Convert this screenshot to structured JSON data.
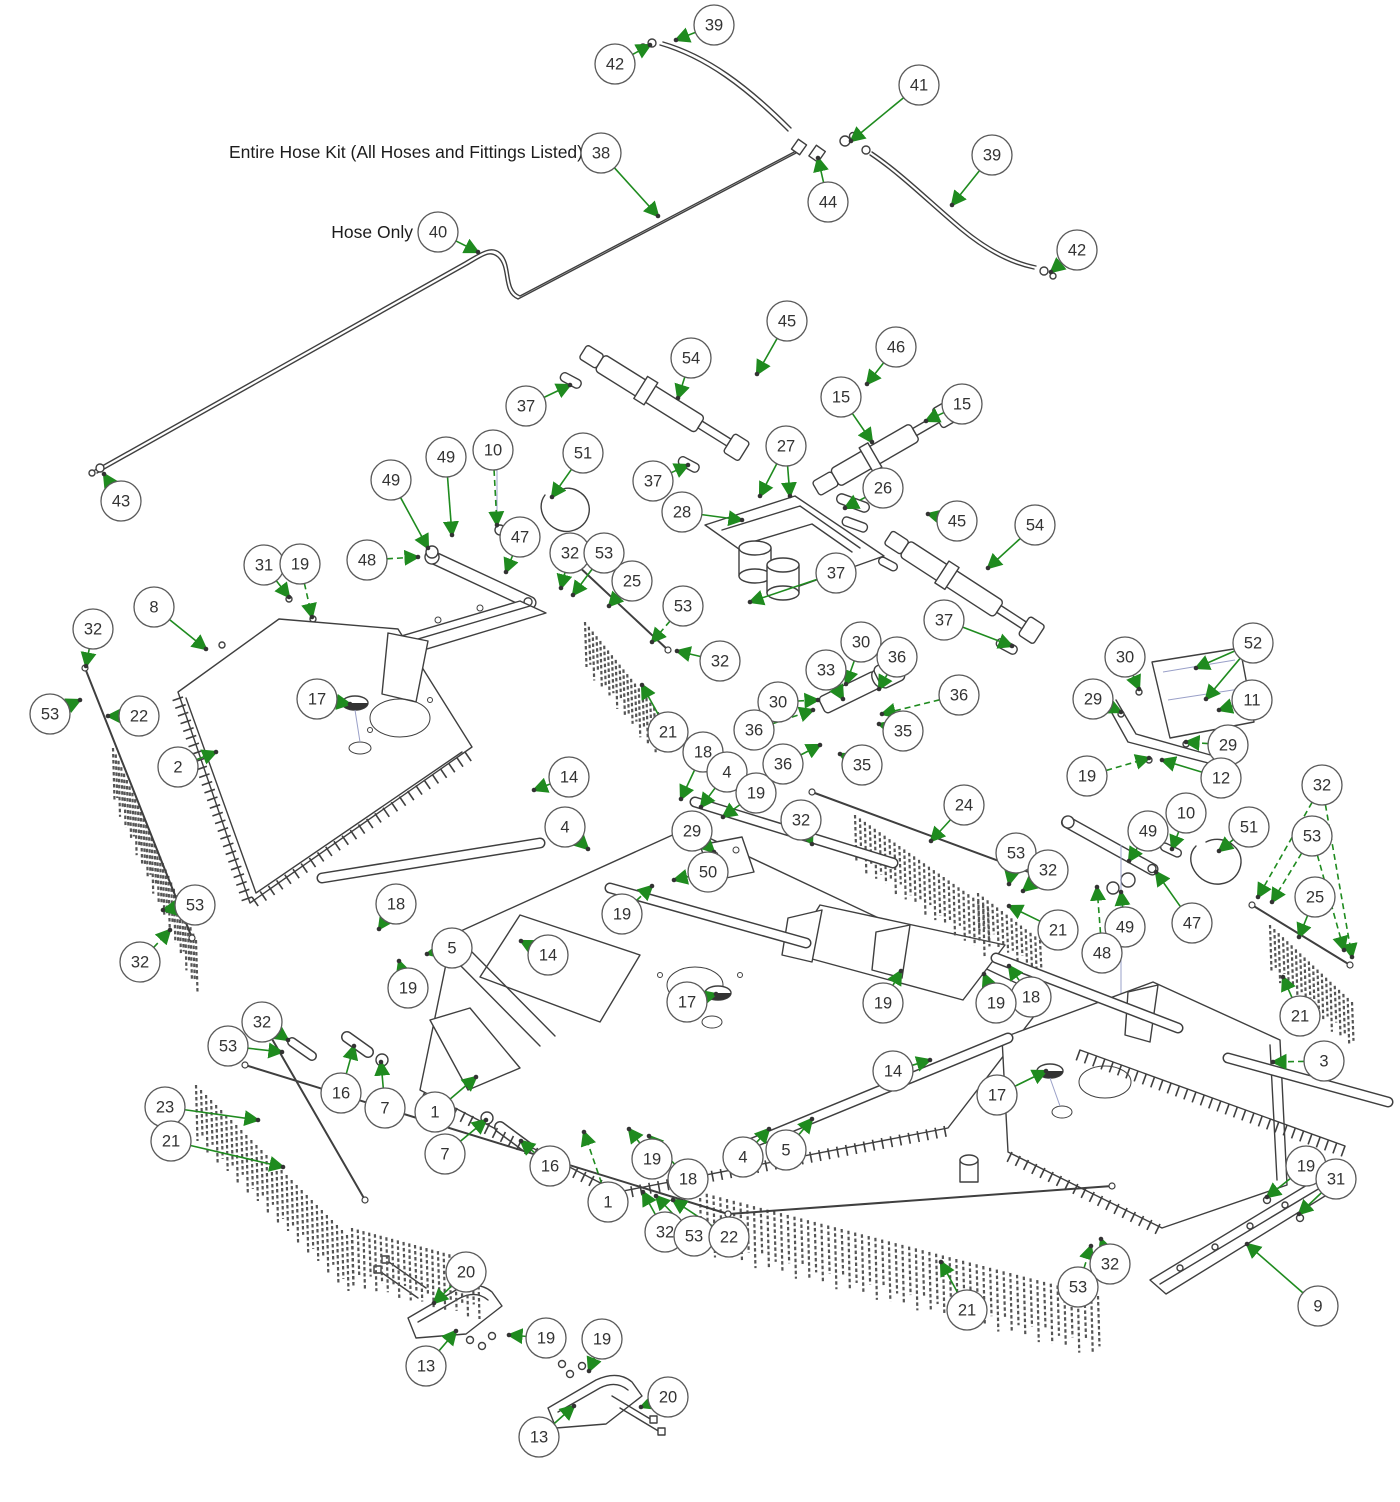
{
  "diagram": {
    "labels": {
      "hose_kit": "Entire Hose Kit (All Hoses and Fittings Listed)",
      "hose_only": "Hose Only"
    },
    "colors": {
      "arrow": "#1f8b1f",
      "line": "#3f3f3f",
      "balloon_stroke": "#5a5a5a",
      "chain": "#555555"
    },
    "balloon_radius": 20,
    "callouts": [
      {
        "n": "39",
        "x": 714,
        "y": 25,
        "tx": 676,
        "ty": 40
      },
      {
        "n": "42",
        "x": 615,
        "y": 64,
        "tx": 650,
        "ty": 45
      },
      {
        "n": "41",
        "x": 919,
        "y": 85,
        "tx": 851,
        "ty": 141
      },
      {
        "n": "38",
        "x": 601,
        "y": 153,
        "tx": 658,
        "ty": 216
      },
      {
        "n": "44",
        "x": 828,
        "y": 202,
        "tx": 818,
        "ty": 158
      },
      {
        "n": "39",
        "x": 992,
        "y": 155,
        "tx": 952,
        "ty": 205
      },
      {
        "n": "42",
        "x": 1077,
        "y": 250,
        "tx": 1051,
        "ty": 272
      },
      {
        "n": "40",
        "x": 438,
        "y": 232,
        "tx": 478,
        "ty": 252
      },
      {
        "n": "43",
        "x": 121,
        "y": 501,
        "tx": 104,
        "ty": 474
      },
      {
        "n": "37",
        "x": 526,
        "y": 406,
        "tx": 570,
        "ty": 385
      },
      {
        "n": "54",
        "x": 691,
        "y": 358,
        "tx": 678,
        "ty": 398
      },
      {
        "n": "45",
        "x": 787,
        "y": 321,
        "tx": 757,
        "ty": 374
      },
      {
        "n": "46",
        "x": 896,
        "y": 347,
        "tx": 867,
        "ty": 384
      },
      {
        "n": "15",
        "x": 841,
        "y": 397,
        "tx": 872,
        "ty": 442
      },
      {
        "n": "15",
        "x": 962,
        "y": 404,
        "tx": 926,
        "ty": 421
      },
      {
        "n": "37",
        "x": 653,
        "y": 481,
        "tx": 688,
        "ty": 465
      },
      {
        "n": "27",
        "x": 786,
        "y": 446,
        "tx": 760,
        "ty": 496,
        "t2x": 790,
        "t2y": 496
      },
      {
        "n": "28",
        "x": 682,
        "y": 512,
        "tx": 742,
        "ty": 520
      },
      {
        "n": "26",
        "x": 883,
        "y": 488,
        "tx": 845,
        "ty": 508,
        "dash": true
      },
      {
        "n": "45",
        "x": 957,
        "y": 521,
        "tx": 928,
        "ty": 514
      },
      {
        "n": "54",
        "x": 1035,
        "y": 525,
        "tx": 988,
        "ty": 568
      },
      {
        "n": "37",
        "x": 836,
        "y": 573,
        "tx": 750,
        "ty": 602
      },
      {
        "n": "37",
        "x": 944,
        "y": 620,
        "tx": 1012,
        "ty": 646
      },
      {
        "n": "10",
        "x": 493,
        "y": 450,
        "tx": 497,
        "ty": 525,
        "dash": true
      },
      {
        "n": "51",
        "x": 583,
        "y": 453,
        "tx": 552,
        "ty": 497
      },
      {
        "n": "49",
        "x": 391,
        "y": 480,
        "tx": 428,
        "ty": 548
      },
      {
        "n": "49",
        "x": 446,
        "y": 457,
        "tx": 452,
        "ty": 535
      },
      {
        "n": "48",
        "x": 367,
        "y": 560,
        "tx": 418,
        "ty": 557,
        "dash": true
      },
      {
        "n": "47",
        "x": 520,
        "y": 537,
        "tx": 506,
        "ty": 572
      },
      {
        "n": "31",
        "x": 264,
        "y": 565,
        "tx": 289,
        "ty": 597
      },
      {
        "n": "19",
        "x": 300,
        "y": 564,
        "tx": 312,
        "ty": 617,
        "dash": true
      },
      {
        "n": "8",
        "x": 154,
        "y": 607,
        "tx": 206,
        "ty": 649
      },
      {
        "n": "32",
        "x": 93,
        "y": 629,
        "tx": 86,
        "ty": 666
      },
      {
        "n": "53",
        "x": 50,
        "y": 714,
        "tx": 80,
        "ty": 700
      },
      {
        "n": "22",
        "x": 139,
        "y": 716,
        "tx": 108,
        "ty": 716
      },
      {
        "n": "2",
        "x": 178,
        "y": 767,
        "tx": 216,
        "ty": 752
      },
      {
        "n": "17",
        "x": 317,
        "y": 699,
        "tx": 350,
        "ty": 704
      },
      {
        "n": "14",
        "x": 569,
        "y": 777,
        "tx": 534,
        "ty": 790
      },
      {
        "n": "21",
        "x": 668,
        "y": 732,
        "tx": 642,
        "ty": 685
      },
      {
        "n": "25",
        "x": 632,
        "y": 581,
        "tx": 609,
        "ty": 606
      },
      {
        "n": "32",
        "x": 570,
        "y": 553,
        "tx": 561,
        "ty": 588
      },
      {
        "n": "53",
        "x": 604,
        "y": 553,
        "tx": 573,
        "ty": 595
      },
      {
        "n": "53",
        "x": 683,
        "y": 606,
        "tx": 652,
        "ty": 642,
        "dash": true
      },
      {
        "n": "32",
        "x": 720,
        "y": 661,
        "tx": 677,
        "ty": 651
      },
      {
        "n": "53",
        "x": 195,
        "y": 905,
        "tx": 163,
        "ty": 910
      },
      {
        "n": "32",
        "x": 140,
        "y": 962,
        "tx": 170,
        "ty": 930,
        "dash": true
      },
      {
        "n": "23",
        "x": 165,
        "y": 1107,
        "tx": 258,
        "ty": 1120
      },
      {
        "n": "21",
        "x": 171,
        "y": 1141,
        "tx": 283,
        "ty": 1167
      },
      {
        "n": "32",
        "x": 262,
        "y": 1022,
        "tx": 288,
        "ty": 1040
      },
      {
        "n": "53",
        "x": 228,
        "y": 1046,
        "tx": 282,
        "ty": 1052
      },
      {
        "n": "16",
        "x": 341,
        "y": 1093,
        "tx": 354,
        "ty": 1046
      },
      {
        "n": "7",
        "x": 385,
        "y": 1108,
        "tx": 381,
        "ty": 1062
      },
      {
        "n": "1",
        "x": 435,
        "y": 1112,
        "tx": 476,
        "ty": 1077
      },
      {
        "n": "7",
        "x": 445,
        "y": 1154,
        "tx": 486,
        "ty": 1120
      },
      {
        "n": "16",
        "x": 550,
        "y": 1166,
        "tx": 521,
        "ty": 1141
      },
      {
        "n": "1",
        "x": 608,
        "y": 1202,
        "tx": 584,
        "ty": 1132,
        "dash": true
      },
      {
        "n": "19",
        "x": 652,
        "y": 1159,
        "tx": 629,
        "ty": 1129
      },
      {
        "n": "18",
        "x": 688,
        "y": 1179,
        "tx": 649,
        "ty": 1136
      },
      {
        "n": "32",
        "x": 665,
        "y": 1232,
        "tx": 643,
        "ty": 1192
      },
      {
        "n": "53",
        "x": 694,
        "y": 1236,
        "tx": 656,
        "ty": 1196
      },
      {
        "n": "22",
        "x": 729,
        "y": 1237,
        "tx": 673,
        "ty": 1200
      },
      {
        "n": "13",
        "x": 426,
        "y": 1366,
        "tx": 456,
        "ty": 1331
      },
      {
        "n": "20",
        "x": 466,
        "y": 1272,
        "tx": 434,
        "ty": 1303
      },
      {
        "n": "19",
        "x": 546,
        "y": 1338,
        "tx": 509,
        "ty": 1335
      },
      {
        "n": "13",
        "x": 539,
        "y": 1437,
        "tx": 574,
        "ty": 1406
      },
      {
        "n": "19",
        "x": 602,
        "y": 1339,
        "tx": 589,
        "ty": 1371
      },
      {
        "n": "20",
        "x": 668,
        "y": 1397,
        "tx": 641,
        "ty": 1407
      },
      {
        "n": "4",
        "x": 565,
        "y": 827,
        "tx": 588,
        "ty": 849
      },
      {
        "n": "29",
        "x": 692,
        "y": 831,
        "tx": 714,
        "ty": 852
      },
      {
        "n": "50",
        "x": 708,
        "y": 872,
        "tx": 674,
        "ty": 880,
        "dash": true
      },
      {
        "n": "19",
        "x": 622,
        "y": 914,
        "tx": 652,
        "ty": 886,
        "dash": true
      },
      {
        "n": "18",
        "x": 396,
        "y": 904,
        "tx": 379,
        "ty": 929
      },
      {
        "n": "5",
        "x": 452,
        "y": 948,
        "tx": 427,
        "ty": 954
      },
      {
        "n": "19",
        "x": 408,
        "y": 988,
        "tx": 399,
        "ty": 961
      },
      {
        "n": "14",
        "x": 548,
        "y": 955,
        "tx": 521,
        "ty": 941
      },
      {
        "n": "17",
        "x": 687,
        "y": 1002,
        "tx": 716,
        "ty": 994
      },
      {
        "n": "19",
        "x": 883,
        "y": 1003,
        "tx": 901,
        "ty": 971
      },
      {
        "n": "18",
        "x": 1031,
        "y": 997,
        "tx": 1009,
        "ty": 966
      },
      {
        "n": "14",
        "x": 893,
        "y": 1071,
        "tx": 930,
        "ty": 1060
      },
      {
        "n": "17",
        "x": 997,
        "y": 1095,
        "tx": 1046,
        "ty": 1071
      },
      {
        "n": "5",
        "x": 786,
        "y": 1150,
        "tx": 812,
        "ty": 1119
      },
      {
        "n": "4",
        "x": 743,
        "y": 1157,
        "tx": 769,
        "ty": 1129
      },
      {
        "n": "18",
        "x": 703,
        "y": 752,
        "tx": 681,
        "ty": 799
      },
      {
        "n": "4",
        "x": 727,
        "y": 772,
        "tx": 701,
        "ty": 807
      },
      {
        "n": "19",
        "x": 756,
        "y": 793,
        "tx": 723,
        "ty": 817
      },
      {
        "n": "30",
        "x": 861,
        "y": 642,
        "tx": 846,
        "ty": 684
      },
      {
        "n": "36",
        "x": 897,
        "y": 657,
        "tx": 879,
        "ty": 689
      },
      {
        "n": "33",
        "x": 826,
        "y": 670,
        "tx": 843,
        "ty": 699
      },
      {
        "n": "30",
        "x": 778,
        "y": 702,
        "tx": 818,
        "ty": 700,
        "dash": true
      },
      {
        "n": "36",
        "x": 754,
        "y": 730,
        "tx": 813,
        "ty": 710,
        "dash": true
      },
      {
        "n": "36",
        "x": 959,
        "y": 695,
        "tx": 882,
        "ty": 714,
        "dash": true
      },
      {
        "n": "35",
        "x": 903,
        "y": 731,
        "tx": 879,
        "ty": 724
      },
      {
        "n": "36",
        "x": 783,
        "y": 764,
        "tx": 820,
        "ty": 745
      },
      {
        "n": "35",
        "x": 862,
        "y": 765,
        "tx": 840,
        "ty": 754
      },
      {
        "n": "32",
        "x": 801,
        "y": 820,
        "tx": 812,
        "ty": 844
      },
      {
        "n": "24",
        "x": 964,
        "y": 805,
        "tx": 931,
        "ty": 841
      },
      {
        "n": "53",
        "x": 1016,
        "y": 853,
        "tx": 1009,
        "ty": 884
      },
      {
        "n": "32",
        "x": 1048,
        "y": 870,
        "tx": 1023,
        "ty": 891
      },
      {
        "n": "21",
        "x": 1058,
        "y": 930,
        "tx": 1009,
        "ty": 906
      },
      {
        "n": "49",
        "x": 1148,
        "y": 831,
        "tx": 1129,
        "ty": 861
      },
      {
        "n": "49",
        "x": 1125,
        "y": 927,
        "tx": 1121,
        "ty": 892
      },
      {
        "n": "48",
        "x": 1102,
        "y": 953,
        "tx": 1097,
        "ty": 887,
        "dash": true
      },
      {
        "n": "19",
        "x": 996,
        "y": 1003,
        "tx": 984,
        "ty": 974
      },
      {
        "n": "30",
        "x": 1125,
        "y": 657,
        "tx": 1139,
        "ty": 689,
        "dash": true
      },
      {
        "n": "52",
        "x": 1253,
        "y": 643,
        "tx": 1196,
        "ty": 668,
        "t2x": 1206,
        "t2y": 699
      },
      {
        "n": "11",
        "x": 1252,
        "y": 700,
        "tx": 1219,
        "ty": 710
      },
      {
        "n": "29",
        "x": 1093,
        "y": 699,
        "tx": 1121,
        "ty": 712
      },
      {
        "n": "29",
        "x": 1228,
        "y": 745,
        "tx": 1186,
        "ty": 742,
        "dash": true
      },
      {
        "n": "19",
        "x": 1087,
        "y": 776,
        "tx": 1149,
        "ty": 758,
        "dash": true
      },
      {
        "n": "12",
        "x": 1221,
        "y": 778,
        "tx": 1162,
        "ty": 760
      },
      {
        "n": "32",
        "x": 1322,
        "y": 785,
        "tx": 1258,
        "ty": 897,
        "t2x": 1352,
        "t2y": 957,
        "dash": true
      },
      {
        "n": "10",
        "x": 1186,
        "y": 813,
        "tx": 1172,
        "ty": 849
      },
      {
        "n": "51",
        "x": 1249,
        "y": 827,
        "tx": 1219,
        "ty": 851
      },
      {
        "n": "53",
        "x": 1312,
        "y": 836,
        "tx": 1272,
        "ty": 902,
        "t2x": 1344,
        "t2y": 950,
        "dash": true
      },
      {
        "n": "25",
        "x": 1315,
        "y": 897,
        "tx": 1299,
        "ty": 937
      },
      {
        "n": "47",
        "x": 1192,
        "y": 923,
        "tx": 1156,
        "ty": 872
      },
      {
        "n": "21",
        "x": 1300,
        "y": 1016,
        "tx": 1283,
        "ty": 977
      },
      {
        "n": "3",
        "x": 1324,
        "y": 1061,
        "tx": 1273,
        "ty": 1062,
        "dash": true
      },
      {
        "n": "19",
        "x": 1306,
        "y": 1166,
        "tx": 1267,
        "ty": 1197
      },
      {
        "n": "31",
        "x": 1336,
        "y": 1179,
        "tx": 1299,
        "ty": 1214
      },
      {
        "n": "9",
        "x": 1318,
        "y": 1306,
        "tx": 1247,
        "ty": 1244
      },
      {
        "n": "32",
        "x": 1110,
        "y": 1264,
        "tx": 1101,
        "ty": 1239
      },
      {
        "n": "53",
        "x": 1078,
        "y": 1287,
        "tx": 1091,
        "ty": 1246,
        "dash": true
      },
      {
        "n": "21",
        "x": 967,
        "y": 1310,
        "tx": 941,
        "ty": 1262
      }
    ],
    "chain_bands": [
      {
        "x1": 113,
        "y1": 748,
        "x2": 196,
        "y2": 940,
        "len": 52,
        "step": 7
      },
      {
        "x1": 196,
        "y1": 1085,
        "x2": 352,
        "y2": 1240,
        "len": 56,
        "step": 7
      },
      {
        "x1": 352,
        "y1": 1228,
        "x2": 478,
        "y2": 1262,
        "len": 55,
        "step": 6
      },
      {
        "x1": 700,
        "y1": 1192,
        "x2": 1098,
        "y2": 1296,
        "len": 58,
        "step": 7
      },
      {
        "x1": 585,
        "y1": 622,
        "x2": 658,
        "y2": 712,
        "len": 45,
        "step": 6
      },
      {
        "x1": 855,
        "y1": 815,
        "x2": 988,
        "y2": 908,
        "len": 48,
        "step": 6
      },
      {
        "x1": 978,
        "y1": 893,
        "x2": 1040,
        "y2": 940,
        "len": 38,
        "step": 6
      },
      {
        "x1": 1270,
        "y1": 925,
        "x2": 1352,
        "y2": 1002,
        "len": 46,
        "step": 6
      }
    ],
    "rods": [
      {
        "x1": 85,
        "y1": 668,
        "x2": 192,
        "y2": 938
      },
      {
        "x1": 268,
        "y1": 1032,
        "x2": 365,
        "y2": 1200
      },
      {
        "x1": 245,
        "y1": 1065,
        "x2": 728,
        "y2": 1214
      },
      {
        "x1": 728,
        "y1": 1214,
        "x2": 1112,
        "y2": 1186
      },
      {
        "x1": 575,
        "y1": 563,
        "x2": 668,
        "y2": 650
      },
      {
        "x1": 812,
        "y1": 792,
        "x2": 1045,
        "y2": 878
      },
      {
        "x1": 1252,
        "y1": 905,
        "x2": 1350,
        "y2": 965
      }
    ],
    "tubes": [
      {
        "x1": 322,
        "y1": 878,
        "x2": 540,
        "y2": 843,
        "w": 8
      },
      {
        "x1": 695,
        "y1": 802,
        "x2": 893,
        "y2": 863,
        "w": 8
      },
      {
        "x1": 610,
        "y1": 888,
        "x2": 806,
        "y2": 943,
        "w": 8
      },
      {
        "x1": 996,
        "y1": 958,
        "x2": 1178,
        "y2": 1028,
        "w": 8
      },
      {
        "x1": 1228,
        "y1": 1058,
        "x2": 1388,
        "y2": 1102,
        "w": 8
      },
      {
        "x1": 745,
        "y1": 1146,
        "x2": 1008,
        "y2": 1038,
        "w": 8
      },
      {
        "x1": 347,
        "y1": 1037,
        "x2": 368,
        "y2": 1052,
        "w": 9
      },
      {
        "x1": 500,
        "y1": 1127,
        "x2": 527,
        "y2": 1147,
        "w": 9
      },
      {
        "x1": 292,
        "y1": 1042,
        "x2": 312,
        "y2": 1056,
        "w": 7
      }
    ]
  }
}
